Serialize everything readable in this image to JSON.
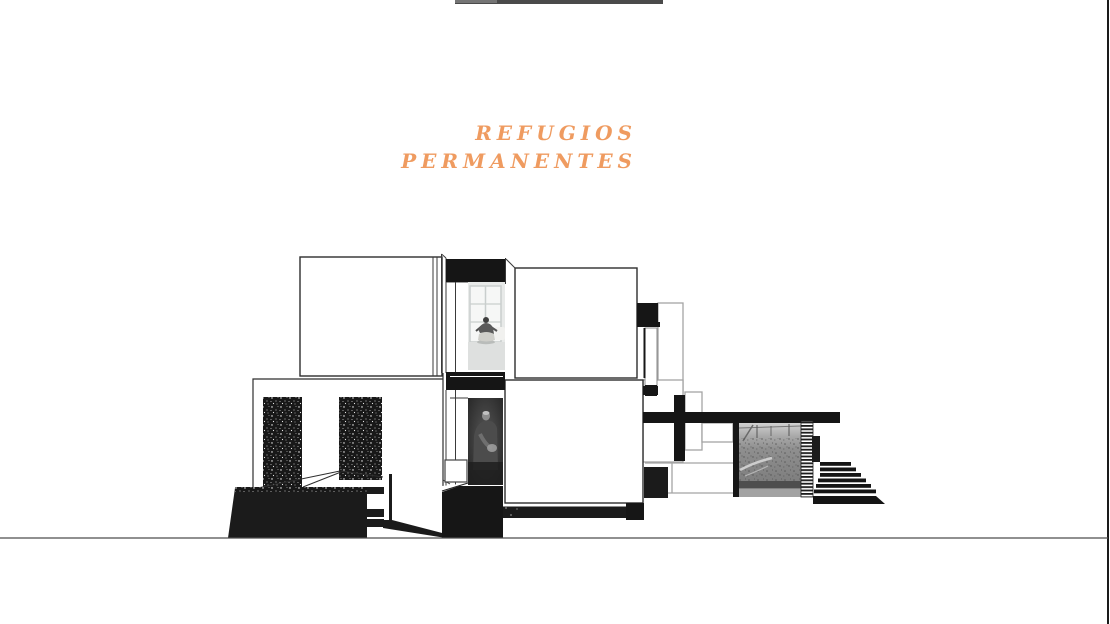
{
  "page": {
    "background": "#ffffff",
    "accent_orange": "#ef9b60",
    "ink_black": "#1b1b1b",
    "outline_gray": "#a4a4a4",
    "ground_line_color": "#4d4d4d",
    "top_bar_color": "#4a4a4a"
  },
  "slide": {
    "title_line1": "REFUGIOS",
    "title_line2": "PERMANENTES"
  },
  "drawing": {
    "type": "architectural-section-collage",
    "photos": [
      {
        "name": "meditation-room-photo",
        "tone": "light",
        "content": "person seated on floor before bright gridded window"
      },
      {
        "name": "workshop-figure-photo",
        "tone": "dark",
        "content": "hunched figure working in dark room"
      },
      {
        "name": "garden-vines-photo",
        "tone": "mid-gray",
        "content": "vine garden with fence posts"
      }
    ],
    "features": [
      "upper-room-box",
      "upper-middle-box",
      "lower-main-box",
      "porch-pillars",
      "roof-plane",
      "roof-column",
      "hatched-strip",
      "stairs",
      "base-blocks",
      "ground-line",
      "top-edge-bar",
      "right-border"
    ]
  }
}
